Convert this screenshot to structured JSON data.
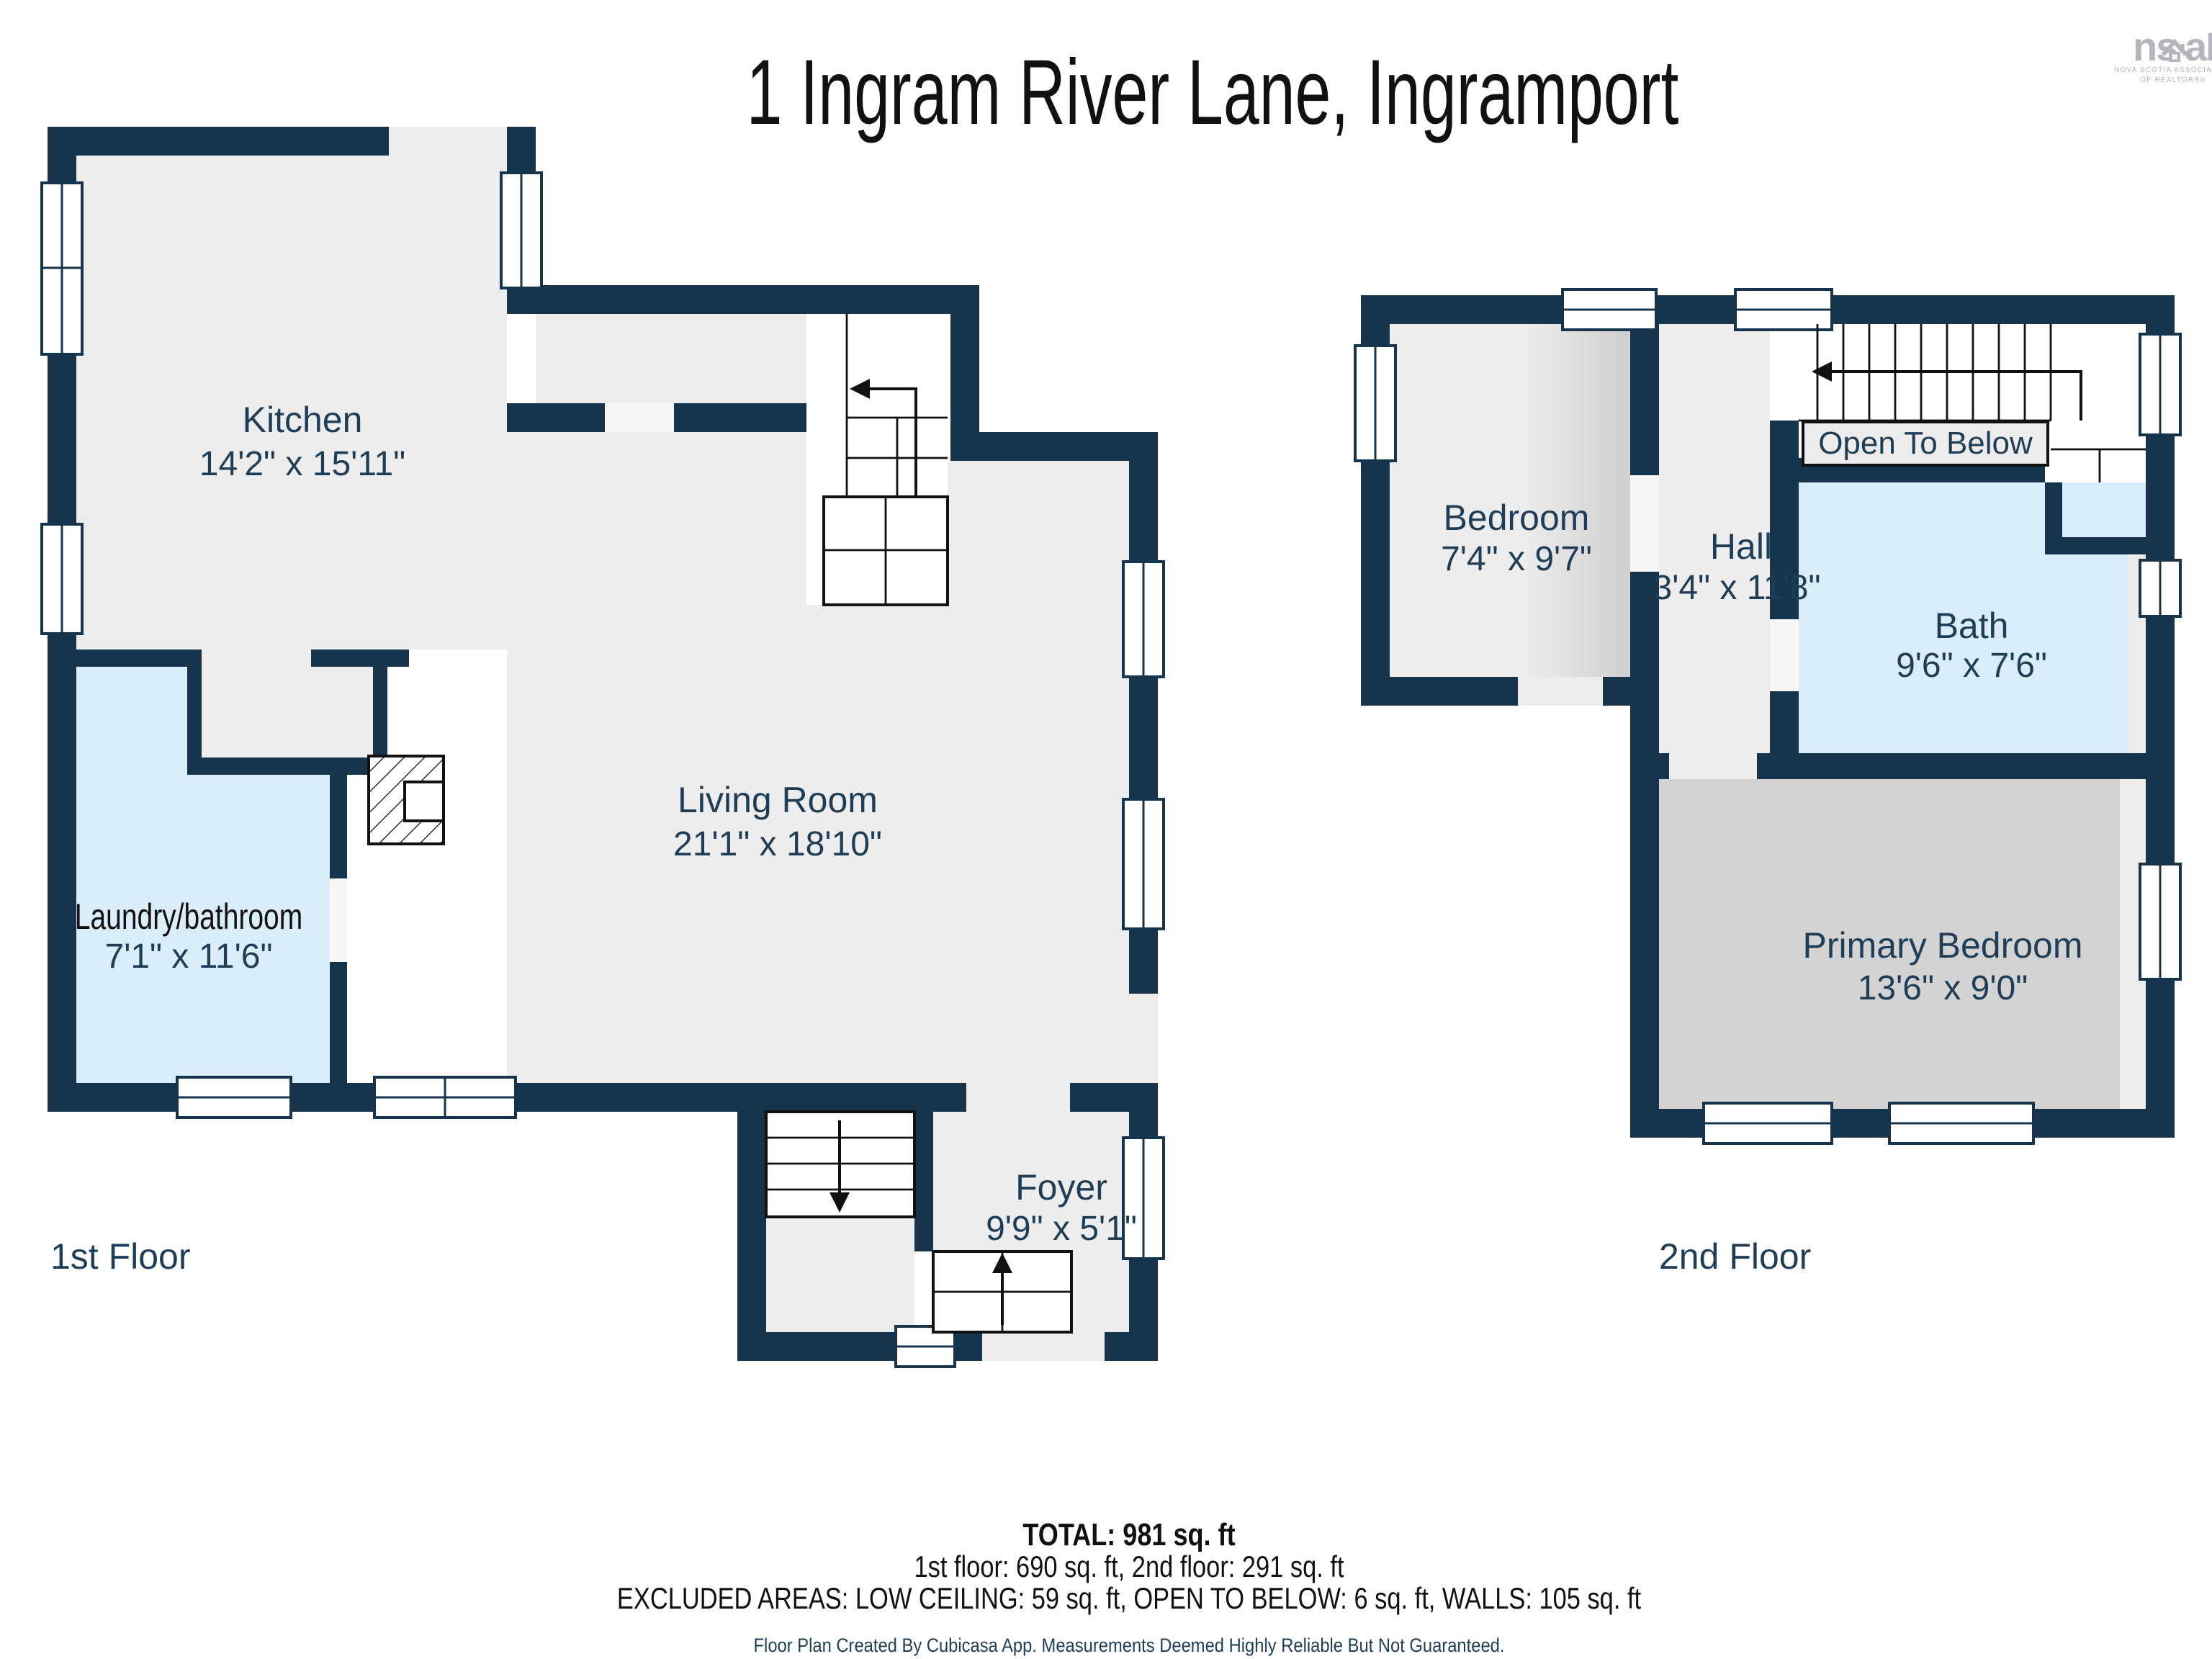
{
  "header": {
    "title": "1 Ingram River Lane, Ingramport"
  },
  "logo": {
    "brand_left": "ns",
    "brand_right": "aR",
    "house_icon": "house-icon",
    "caption_line1": "NOVA SCOTIA ASSOCIATION",
    "caption_line2": "OF REALTORS®"
  },
  "floors": {
    "first": {
      "label": "1st Floor",
      "rooms": [
        {
          "name": "Kitchen",
          "dimensions": "14'2\" x 15'11\""
        },
        {
          "name": "Living Room",
          "dimensions": "21'1\" x 18'10\""
        },
        {
          "name": "Laundry/bathroom",
          "dimensions": "7'1\" x 11'6\"",
          "highlight": "#d9edfa"
        },
        {
          "name": "Foyer",
          "dimensions": "9'9\" x 5'1\""
        }
      ]
    },
    "second": {
      "label": "2nd Floor",
      "rooms": [
        {
          "name": "Bedroom",
          "dimensions": "7'4\" x 9'7\""
        },
        {
          "name": "Hall",
          "dimensions": "3'4\" x 11'8\""
        },
        {
          "name": "Bath",
          "dimensions": "9'6\" x 7'6\"",
          "highlight": "#d9edfa"
        },
        {
          "name": "Primary Bedroom",
          "dimensions": "13'6\" x 9'0\""
        }
      ],
      "annotations": {
        "open_to_below": "Open To Below"
      }
    }
  },
  "footer": {
    "total": "TOTAL: 981 sq. ft",
    "floors_breakdown": "1st floor: 690 sq. ft, 2nd floor: 291 sq. ft",
    "excluded": "EXCLUDED AREAS: LOW CEILING: 59 sq. ft, OPEN TO BELOW: 6 sq. ft, WALLS: 105 sq. ft",
    "disclaimer": "Floor Plan Created By Cubicasa App. Measurements Deemed Highly Reliable But Not Guaranteed."
  },
  "colors": {
    "wall": "#17344d",
    "room_floor": "#ededed",
    "wet_room_floor": "#d9edfa",
    "primary_bedroom_floor": "#d3d3d3",
    "low_ceiling_shade": "#cfcfd1",
    "label_text": "#1e3d57",
    "title_text": "#111111",
    "logo_gray": "#b5b5bd"
  }
}
